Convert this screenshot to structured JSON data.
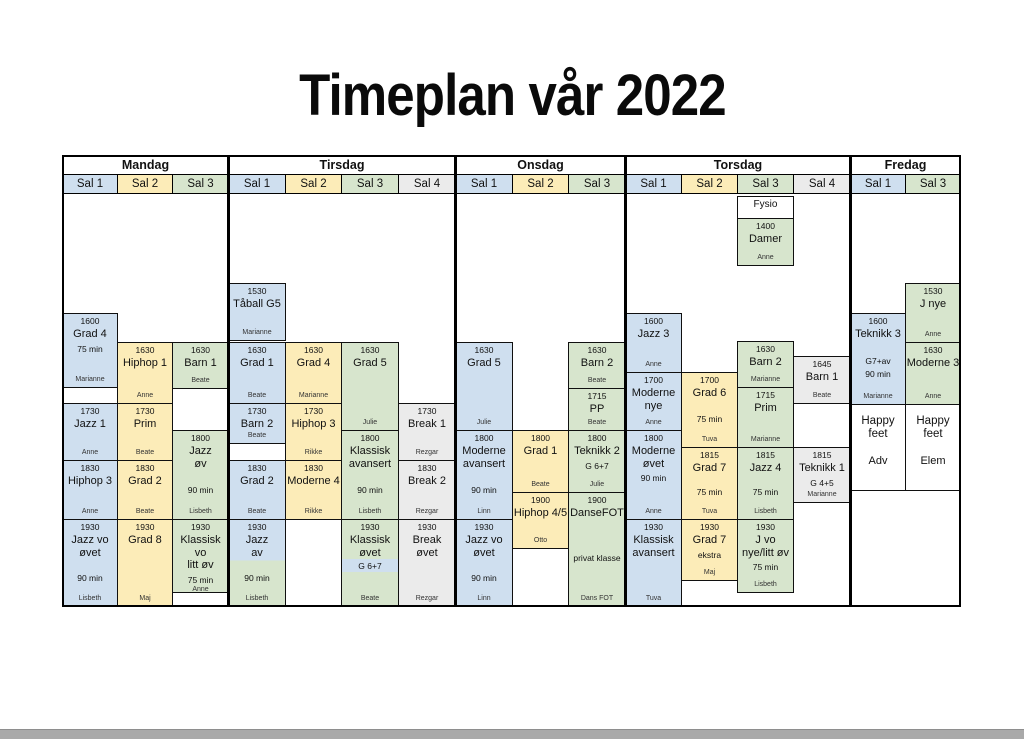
{
  "title": "Timeplan vår 2022",
  "colors": {
    "blue": "#cfdfef",
    "yellow": "#fcecb8",
    "green": "#d7e5cd",
    "gray": "#ebebeb",
    "white": "#ffffff",
    "bottom_bar": "#a9a9a9"
  },
  "table": {
    "x": 62,
    "y": 155,
    "w": 899,
    "h": 452,
    "separators": [
      228,
      455,
      625,
      850
    ],
    "day_groups": [
      {
        "label": "Mandag",
        "x": 62,
        "w": 166
      },
      {
        "label": "Tirsdag",
        "x": 228,
        "w": 227
      },
      {
        "label": "Onsdag",
        "x": 455,
        "w": 170
      },
      {
        "label": "Torsdag",
        "x": 625,
        "w": 225
      },
      {
        "label": "Fredag",
        "x": 850,
        "w": 110
      }
    ],
    "columns": [
      {
        "day": "Mandag",
        "label": "Sal 1",
        "color": "blue",
        "x": 62,
        "w": 55
      },
      {
        "day": "Mandag",
        "label": "Sal 2",
        "color": "yellow",
        "x": 117,
        "w": 55
      },
      {
        "day": "Mandag",
        "label": "Sal 3",
        "color": "green",
        "x": 172,
        "w": 56
      },
      {
        "day": "Tirsdag",
        "label": "Sal 1",
        "color": "blue",
        "x": 228,
        "w": 57
      },
      {
        "day": "Tirsdag",
        "label": "Sal 2",
        "color": "yellow",
        "x": 285,
        "w": 56
      },
      {
        "day": "Tirsdag",
        "label": "Sal 3",
        "color": "green",
        "x": 341,
        "w": 57
      },
      {
        "day": "Tirsdag",
        "label": "Sal 4",
        "color": "gray",
        "x": 398,
        "w": 57
      },
      {
        "day": "Onsdag",
        "label": "Sal 1",
        "color": "blue",
        "x": 455,
        "w": 57
      },
      {
        "day": "Onsdag",
        "label": "Sal 2",
        "color": "yellow",
        "x": 512,
        "w": 56
      },
      {
        "day": "Onsdag",
        "label": "Sal 3",
        "color": "green",
        "x": 568,
        "w": 57
      },
      {
        "day": "Torsdag",
        "label": "Sal 1",
        "color": "blue",
        "x": 625,
        "w": 56
      },
      {
        "day": "Torsdag",
        "label": "Sal 2",
        "color": "yellow",
        "x": 681,
        "w": 56
      },
      {
        "day": "Torsdag",
        "label": "Sal 3",
        "color": "green",
        "x": 737,
        "w": 56
      },
      {
        "day": "Torsdag",
        "label": "Sal 4",
        "color": "gray",
        "x": 793,
        "w": 57
      },
      {
        "day": "Fredag",
        "label": "Sal 1",
        "color": "blue",
        "x": 850,
        "w": 55
      },
      {
        "day": "Fredag",
        "label": "Sal 3",
        "color": "green",
        "x": 905,
        "w": 55
      }
    ]
  },
  "cells": [
    {
      "col": 0,
      "y": 313,
      "h": 74,
      "bg": "blue",
      "time": "1600",
      "title": "Grad 4",
      "sub": "75 min",
      "subTop": true,
      "name": "Marianne"
    },
    {
      "col": 0,
      "y": 387,
      "h": 16,
      "bg": "white"
    },
    {
      "col": 0,
      "y": 403,
      "h": 57,
      "bg": "blue",
      "time": "1730",
      "title": "Jazz 1",
      "name": "Anne"
    },
    {
      "col": 0,
      "y": 460,
      "h": 59,
      "bg": "blue",
      "time": "1830",
      "title": "Hiphop 3",
      "name": "Anne"
    },
    {
      "col": 0,
      "y": 519,
      "h": 87,
      "bg": "blue",
      "time": "1930",
      "title": "Jazz vo\nøvet",
      "sub": "90 min",
      "name": "Lisbeth"
    },
    {
      "col": 1,
      "y": 342,
      "h": 61,
      "bg": "yellow",
      "time": "1630",
      "title": "Hiphop 1",
      "name": "Anne"
    },
    {
      "col": 1,
      "y": 403,
      "h": 57,
      "bg": "yellow",
      "time": "1730",
      "title": "Prim",
      "name": "Beate"
    },
    {
      "col": 1,
      "y": 460,
      "h": 59,
      "bg": "yellow",
      "time": "1830",
      "title": "Grad 2",
      "name": "Beate"
    },
    {
      "col": 1,
      "y": 519,
      "h": 87,
      "bg": "yellow",
      "time": "1930",
      "title": "Grad 8",
      "name": "Maj"
    },
    {
      "col": 2,
      "y": 342,
      "h": 46,
      "bg": "green",
      "time": "1630",
      "title": "Barn 1",
      "name": "Beate"
    },
    {
      "col": 2,
      "y": 430,
      "h": 89,
      "bg": "green",
      "time": "1800",
      "title": "Jazz\nøv",
      "sub": "90 min",
      "name": "Lisbeth"
    },
    {
      "col": 2,
      "y": 519,
      "h": 73,
      "bg": "green",
      "time": "1930",
      "title": "Klassisk vo\nlitt øv",
      "sub": "75 min",
      "subTop": true,
      "name": "Anne"
    },
    {
      "col": 2,
      "y": 592,
      "h": 14,
      "bg": "white"
    },
    {
      "col": 3,
      "y": 283,
      "h": 57,
      "bg": "blue",
      "time": "1530",
      "title": "Tåball G5",
      "name": "Marianne"
    },
    {
      "col": 3,
      "y": 342,
      "h": 61,
      "bg": "blue",
      "time": "1630",
      "title": "Grad 1",
      "name": "Beate"
    },
    {
      "col": 3,
      "y": 403,
      "h": 40,
      "bg": "blue",
      "time": "1730",
      "title": "Barn 2",
      "name": "Beate"
    },
    {
      "col": 3,
      "y": 443,
      "h": 17,
      "bg": "white"
    },
    {
      "col": 3,
      "y": 460,
      "h": 59,
      "bg": "blue",
      "time": "1830",
      "title": "Grad 2",
      "name": "Beate"
    },
    {
      "col": 3,
      "y": 519,
      "h": 87,
      "bg": "bluegreen",
      "time": "1930",
      "title": "Jazz\nav",
      "sub": "90 min",
      "name": "Lisbeth"
    },
    {
      "col": 4,
      "y": 342,
      "h": 61,
      "bg": "yellow",
      "time": "1630",
      "title": "Grad 4",
      "name": "Marianne"
    },
    {
      "col": 4,
      "y": 403,
      "h": 57,
      "bg": "yellow",
      "time": "1730",
      "title": "Hiphop 3",
      "name": "Rikke"
    },
    {
      "col": 4,
      "y": 460,
      "h": 59,
      "bg": "yellow",
      "time": "1830",
      "title": "Moderne 4",
      "name": "Rikke"
    },
    {
      "col": 5,
      "y": 342,
      "h": 88,
      "bg": "green",
      "time": "1630",
      "title": "Grad 5",
      "name": "Julie"
    },
    {
      "col": 5,
      "y": 430,
      "h": 89,
      "bg": "green",
      "time": "1800",
      "title": "Klassisk\navansert",
      "sub": "90 min",
      "name": "Lisbeth"
    },
    {
      "col": 5,
      "y": 519,
      "h": 87,
      "bg": "green",
      "time": "1930",
      "title": "Klassisk\nøvet",
      "sub": "G 6+7",
      "subTop": true,
      "subBand": true,
      "name": "Beate"
    },
    {
      "col": 6,
      "y": 403,
      "h": 57,
      "bg": "gray",
      "time": "1730",
      "title": "Break 1",
      "name": "Rezgar"
    },
    {
      "col": 6,
      "y": 460,
      "h": 59,
      "bg": "gray",
      "time": "1830",
      "title": "Break 2",
      "name": "Rezgar"
    },
    {
      "col": 6,
      "y": 519,
      "h": 87,
      "bg": "gray",
      "time": "1930",
      "title": "Break\nøvet",
      "name": "Rezgar"
    },
    {
      "col": 7,
      "y": 342,
      "h": 88,
      "bg": "blue",
      "time": "1630",
      "title": "Grad 5",
      "name": "Julie"
    },
    {
      "col": 7,
      "y": 430,
      "h": 89,
      "bg": "blue",
      "time": "1800",
      "title": "Moderne\navansert",
      "sub": "90 min",
      "name": "Linn"
    },
    {
      "col": 7,
      "y": 519,
      "h": 87,
      "bg": "blue",
      "time": "1930",
      "title": "Jazz vo\nøvet",
      "sub": "90 min",
      "name": "Linn"
    },
    {
      "col": 8,
      "y": 430,
      "h": 62,
      "bg": "yellow",
      "time": "1800",
      "title": "Grad 1",
      "name": "Beate"
    },
    {
      "col": 8,
      "y": 492,
      "h": 56,
      "bg": "yellow",
      "time": "1900",
      "title": "Hiphop 4/5",
      "name": "Otto"
    },
    {
      "col": 9,
      "y": 342,
      "h": 46,
      "bg": "green",
      "time": "1630",
      "title": "Barn 2",
      "name": "Beate"
    },
    {
      "col": 9,
      "y": 388,
      "h": 42,
      "bg": "green",
      "time": "1715",
      "title": "PP",
      "name": "Beate"
    },
    {
      "col": 9,
      "y": 430,
      "h": 62,
      "bg": "green",
      "time": "1800",
      "title": "Teknikk 2",
      "sub": "G 6+7",
      "subTop": true,
      "name": "Julie"
    },
    {
      "col": 9,
      "y": 492,
      "h": 114,
      "bg": "green",
      "time": "1900",
      "title": "DanseFOT",
      "sub": "privat klasse",
      "name": "Dans FOT"
    },
    {
      "col": 10,
      "y": 313,
      "h": 59,
      "bg": "blue",
      "time": "1600",
      "title": "Jazz 3",
      "name": "Anne"
    },
    {
      "col": 10,
      "y": 372,
      "h": 58,
      "bg": "blue",
      "time": "1700",
      "title": "Moderne\nnye",
      "name": "Anne"
    },
    {
      "col": 10,
      "y": 430,
      "h": 89,
      "bg": "blue",
      "time": "1800",
      "title": "Moderne\nøvet",
      "sub": "90 min",
      "subTop": true,
      "name": "Anne"
    },
    {
      "col": 10,
      "y": 519,
      "h": 87,
      "bg": "blue",
      "time": "1930",
      "title": "Klassisk\navansert",
      "name": "Tuva"
    },
    {
      "col": 11,
      "y": 372,
      "h": 75,
      "bg": "yellow",
      "time": "1700",
      "title": "Grad 6",
      "sub": "75 min",
      "name": "Tuva"
    },
    {
      "col": 11,
      "y": 447,
      "h": 72,
      "bg": "yellow",
      "time": "1815",
      "title": "Grad 7",
      "sub": "75 min",
      "name": "Tuva"
    },
    {
      "col": 11,
      "y": 519,
      "h": 61,
      "bg": "yellow",
      "time": "1930",
      "title": "Grad 7",
      "sub": "ekstra",
      "subTop": true,
      "name": "Maj"
    },
    {
      "col": 12,
      "y": 196,
      "h": 22,
      "bg": "white",
      "title": "Fysio",
      "small": true
    },
    {
      "col": 12,
      "y": 218,
      "h": 47,
      "bg": "green",
      "time": "1400",
      "title": "Damer",
      "name": "Anne"
    },
    {
      "col": 12,
      "y": 341,
      "h": 46,
      "bg": "green",
      "time": "1630",
      "title": "Barn 2",
      "name": "Marianne"
    },
    {
      "col": 12,
      "y": 387,
      "h": 60,
      "bg": "green",
      "time": "1715",
      "title": "Prim",
      "name": "Marianne"
    },
    {
      "col": 12,
      "y": 447,
      "h": 72,
      "bg": "green",
      "time": "1815",
      "title": "Jazz 4",
      "sub": "75 min",
      "name": "Lisbeth"
    },
    {
      "col": 12,
      "y": 519,
      "h": 73,
      "bg": "green",
      "time": "1930",
      "title": "J vo\nnye/litt øv",
      "sub": "75 min",
      "subTop": true,
      "name": "Lisbeth"
    },
    {
      "col": 13,
      "y": 356,
      "h": 47,
      "bg": "gray",
      "time": "1645",
      "title": "Barn 1",
      "name": "Beate"
    },
    {
      "col": 13,
      "y": 447,
      "h": 55,
      "bg": "gray",
      "time": "1815",
      "title": "Teknikk 1",
      "sub": "G 4+5",
      "subTop": true,
      "name": "Marianne"
    },
    {
      "col": 14,
      "y": 313,
      "h": 91,
      "bg": "blue",
      "time": "1600",
      "title": "Teknikk 3",
      "sub": "G7+av",
      "sub2": "90 min",
      "name": "Marianne"
    },
    {
      "col": 14,
      "y": 404,
      "h": 86,
      "bg": "white",
      "title": "Happy feet",
      "sub": "Adv",
      "plain": true
    },
    {
      "col": 15,
      "y": 283,
      "h": 59,
      "bg": "green",
      "time": "1530",
      "title": "J nye",
      "name": "Anne"
    },
    {
      "col": 15,
      "y": 342,
      "h": 62,
      "bg": "green",
      "time": "1630",
      "title": "Moderne 3",
      "name": "Anne"
    },
    {
      "col": 15,
      "y": 404,
      "h": 86,
      "bg": "white",
      "title": "Happy feet",
      "sub": "Elem",
      "plain": true
    }
  ]
}
